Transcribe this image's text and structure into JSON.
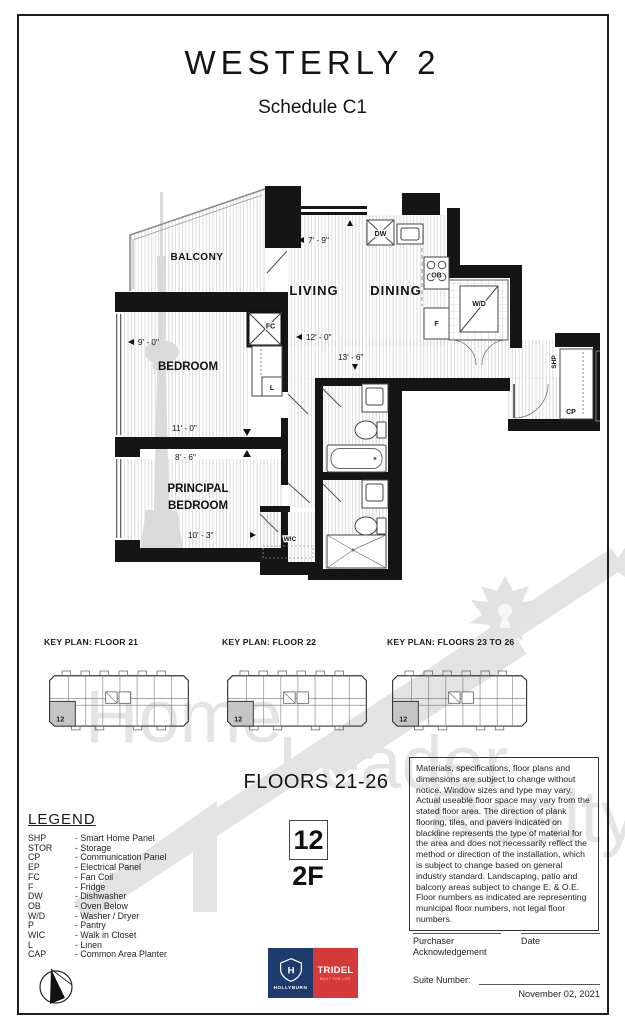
{
  "header": {
    "title": "WESTERLY 2",
    "subtitle": "Schedule C1"
  },
  "plan": {
    "rooms": {
      "balcony": "BALCONY",
      "living": "LIVING",
      "dining": "DINING",
      "bedroom": "BEDROOM",
      "principal1": "PRINCIPAL",
      "principal2": "BEDROOM"
    },
    "fixtures": {
      "dw": "DW",
      "ob": "OB",
      "f": "F",
      "wd": "W/D",
      "fc": "FC",
      "l": "L",
      "wic": "WIC",
      "shp": "SHP",
      "cp": "CP"
    },
    "dims": {
      "top": "7' - 9\"",
      "bedroom_w": "9' - 0\"",
      "living_w": "12' - 0\"",
      "hall": "13' - 6\"",
      "bedroom_l": "11' - 0\"",
      "principal_w": "8' - 6\"",
      "principal_l": "10' - 3\""
    }
  },
  "key_plans": [
    {
      "title": "KEY PLAN: FLOOR 21",
      "unit": "12"
    },
    {
      "title": "KEY PLAN: FLOOR 22",
      "unit": "12"
    },
    {
      "title": "KEY PLAN: FLOORS 23 TO 26",
      "unit": "12"
    }
  ],
  "unit": {
    "floors_label": "FLOORS 21-26",
    "number": "12",
    "type": "2F"
  },
  "legend": {
    "title": "LEGEND",
    "items": [
      {
        "abbr": "SHP",
        "desc": "- Smart Home Panel"
      },
      {
        "abbr": "STOR",
        "desc": "- Storage"
      },
      {
        "abbr": "CP",
        "desc": "- Communication Panel"
      },
      {
        "abbr": "EP",
        "desc": "- Electrical Panel"
      },
      {
        "abbr": "FC",
        "desc": "- Fan Coil"
      },
      {
        "abbr": "F",
        "desc": "- Fridge"
      },
      {
        "abbr": "DW",
        "desc": "- Dishwasher"
      },
      {
        "abbr": "OB",
        "desc": "- Oven Below"
      },
      {
        "abbr": "W/D",
        "desc": "- Washer / Dryer"
      },
      {
        "abbr": "P",
        "desc": "- Pantry"
      },
      {
        "abbr": "WIC",
        "desc": "- Walk in Closet"
      },
      {
        "abbr": "L",
        "desc": "- Linen"
      },
      {
        "abbr": "CAP",
        "desc": "- Common Area Planter"
      }
    ]
  },
  "disclaimer": "Materials, specifications, floor plans and dimensions are subject to change without notice. Window sizes and type may vary. Actual useable floor space may vary from the stated floor area. The direction of plank flooring, tiles, and pavers indicated on blackline represents the type of material for the area and does not necessarily reflect the method or direction of the installation, which is subject to change based on general industry standard. Landscaping, patio and balcony areas subject to change E. & O.E. Floor numbers as indicated are representing municipal floor numbers, not legal floor numbers.",
  "watermark": {
    "word1": "Home",
    "word2": "Leader",
    "word3": "Realty"
  },
  "logos": {
    "hollyburn": "HOLLYBURN",
    "tridel": "TRIDEL",
    "tridel_tag": "BUILT FOR LIFE"
  },
  "signoff": {
    "purchaser": "Purchaser",
    "acknowledgement": "Acknowledgement",
    "date_label": "Date",
    "suite_label": "Suite Number:",
    "doc_date": "November 02, 2021"
  },
  "colors": {
    "hollyburn_blue": "#1d3b6d",
    "tridel_red": "#d63a38",
    "watermark_gray": "#e2e2e2"
  }
}
